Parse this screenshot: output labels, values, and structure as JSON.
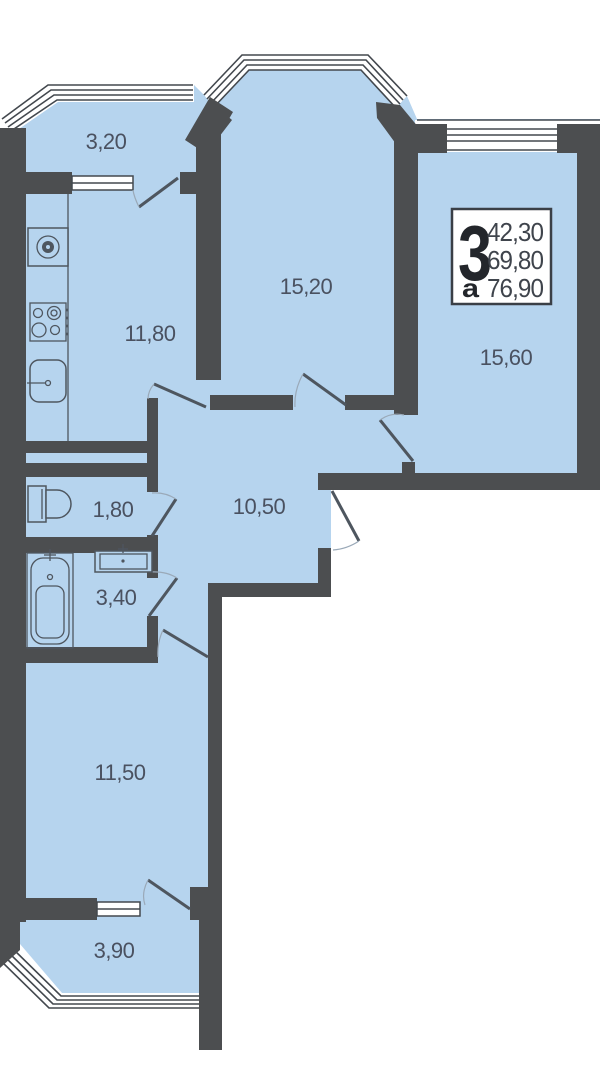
{
  "plan": {
    "info_box": {
      "rooms_count": "3",
      "letter": "а",
      "area_living": "42,30",
      "area_main": "69,80",
      "area_total": "76,90"
    },
    "rooms": [
      {
        "id": "balcony-top",
        "label": "3,20"
      },
      {
        "id": "kitchen",
        "label": "11,80"
      },
      {
        "id": "living-room",
        "label": "15,20"
      },
      {
        "id": "bedroom-right",
        "label": "15,60"
      },
      {
        "id": "hall",
        "label": "10,50"
      },
      {
        "id": "wc",
        "label": "1,80"
      },
      {
        "id": "bathroom",
        "label": "3,40"
      },
      {
        "id": "bedroom-left",
        "label": "11,50"
      },
      {
        "id": "balcony-bottom",
        "label": "3,90"
      }
    ],
    "colors": {
      "floor": "#b6d4ee",
      "wall": "#4c4e50",
      "line": "#4e565f",
      "text": "#4a5160"
    }
  }
}
